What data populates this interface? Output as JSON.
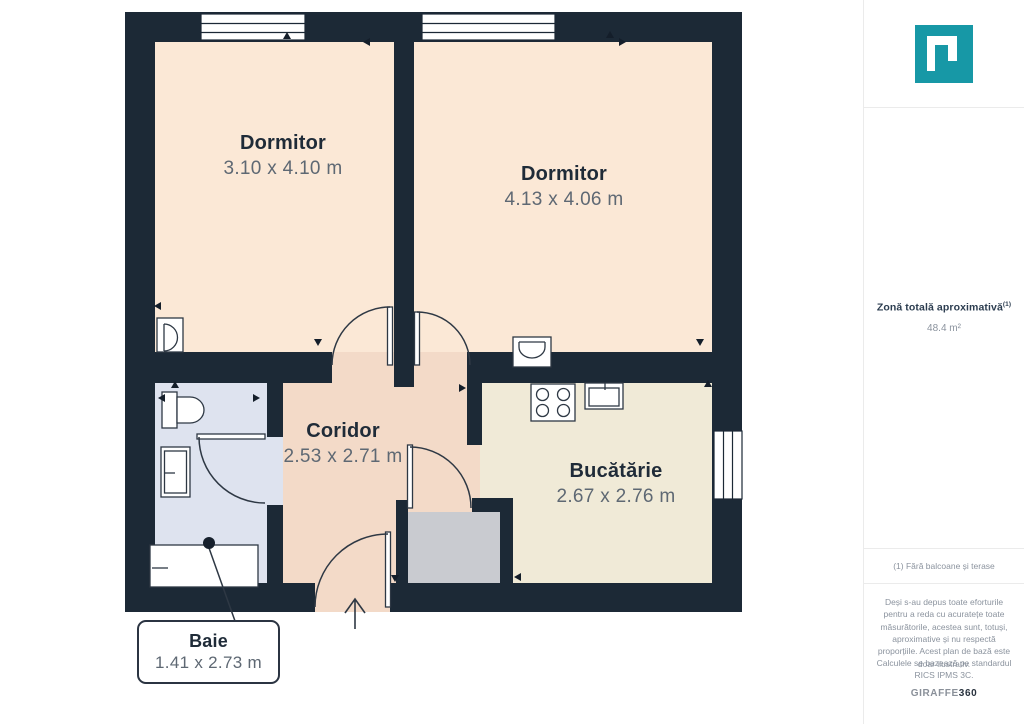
{
  "floorplan": {
    "rooms": [
      {
        "name": "Dormitor",
        "dims": "3.10 x 4.10 m"
      },
      {
        "name": "Dormitor",
        "dims": "4.13 x 4.06 m"
      },
      {
        "name": "Coridor",
        "dims": "2.53 x 2.71 m"
      },
      {
        "name": "Bucătărie",
        "dims": "2.67 x 2.76 m"
      },
      {
        "name": "Baie",
        "dims": "1.41 x 2.73 m"
      }
    ],
    "colors": {
      "wall": "#1c2936",
      "bedroom_floor": "#fbe8d6",
      "corridor_floor": "#f3dac8",
      "kitchen_floor": "#f0ead7",
      "bathroom_floor": "#dee3ef",
      "closet_floor": "#c9cbd0"
    }
  },
  "sidebar": {
    "logo_color": "#1798a6",
    "area_title": "Zonă totală aproximativă",
    "area_title_note": "(1)",
    "area_value": "48.4 m²",
    "footnote": "(1) Fără balcoane și terase",
    "disclaimer": "Deși s-au depus toate eforturile pentru a reda cu acuratețe toate măsurătorile, acestea sunt, totuși, aproximative și nu respectă proporțiile. Acest plan de bază este doar ilustrativ.",
    "standard": "Calculele se bazează pe standardul RICS IPMS 3C.",
    "brand": {
      "part1": "GIRAFFE",
      "part2": "360"
    }
  }
}
